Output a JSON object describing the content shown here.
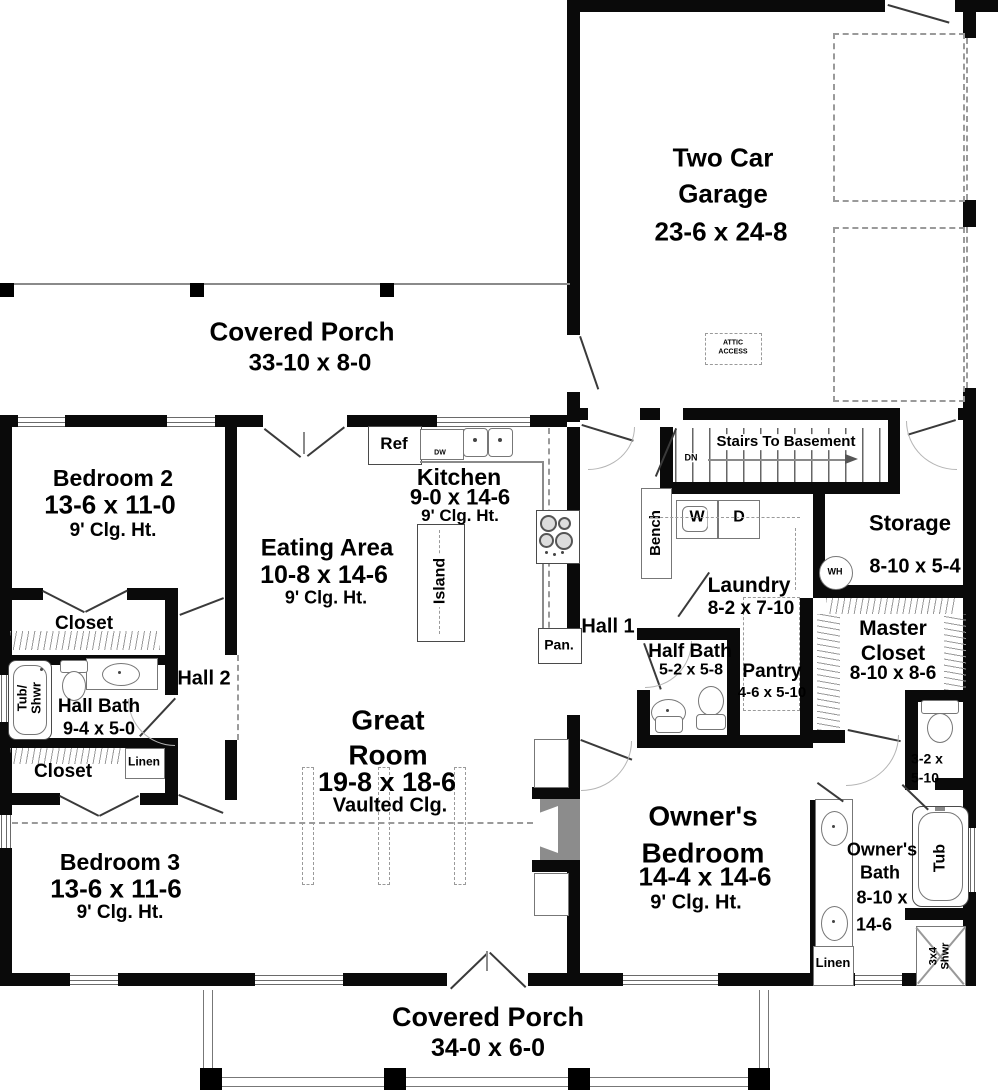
{
  "rooms": {
    "garage": {
      "l1": "Two Car",
      "l2": "Garage",
      "dims": "23-6 x 24-8"
    },
    "porch_top": {
      "name": "Covered Porch",
      "dims": "33-10 x 8-0"
    },
    "porch_bottom": {
      "name": "Covered Porch",
      "dims": "34-0 x 6-0"
    },
    "bedroom2": {
      "name": "Bedroom 2",
      "dims": "13-6 x 11-0",
      "clg": "9' Clg. Ht."
    },
    "bedroom3": {
      "name": "Bedroom 3",
      "dims": "13-6 x 11-6",
      "clg": "9' Clg. Ht."
    },
    "eating": {
      "name": "Eating Area",
      "dims": "10-8 x 14-6",
      "clg": "9' Clg. Ht."
    },
    "kitchen": {
      "name": "Kitchen",
      "dims": "9-0 x 14-6",
      "clg": "9' Clg. Ht."
    },
    "great": {
      "l1": "Great",
      "l2": "Room",
      "dims": "19-8 x 18-6",
      "clg": "Vaulted Clg."
    },
    "owners_bed": {
      "l1": "Owner's",
      "l2": "Bedroom",
      "dims": "14-4 x 14-6",
      "clg": "9' Clg. Ht."
    },
    "owners_bath": {
      "l1": "Owner's",
      "l2": "Bath",
      "l3": "8-10 x",
      "l4": "14-6"
    },
    "master_closet": {
      "l1": "Master",
      "l2": "Closet",
      "dims": "8-10 x 8-6"
    },
    "storage": {
      "name": "Storage",
      "dims": "8-10 x 5-4"
    },
    "laundry": {
      "name": "Laundry",
      "dims": "8-2 x 7-10"
    },
    "half_bath": {
      "name": "Half Bath",
      "dims": "5-2 x 5-8"
    },
    "hall_bath": {
      "name": "Hall Bath",
      "dims": "9-4 x 5-0"
    },
    "pantry": {
      "name": "Pantry",
      "dims": "4-6 x 5-10"
    },
    "wc": {
      "l1": "3-2 x",
      "l2": "5-10"
    },
    "hall1": {
      "name": "Hall 1"
    },
    "hall2": {
      "name": "Hall 2"
    },
    "closet1": {
      "name": "Closet"
    },
    "closet2": {
      "name": "Closet"
    }
  },
  "labels": {
    "stairs": "Stairs To Basement",
    "dn": "DN",
    "bench": "Bench",
    "washer": "W",
    "dryer": "D",
    "water_heater": "WH",
    "linen": "Linen",
    "ref": "Ref",
    "dw": "DW",
    "island": "Island",
    "pantry_cab": "Pan.",
    "tub_shwr_1": "Tub/",
    "tub_shwr_2": "Shwr",
    "tub": "Tub",
    "shower_1": "3x4",
    "shower_2": "Shwr",
    "attic_1": "ATTIC",
    "attic_2": "ACCESS"
  },
  "colors": {
    "wall": "#0a0a0a",
    "line": "#8a8a8a",
    "hatch": "#9a9a9a",
    "fireplace": "#8c8c8c"
  }
}
